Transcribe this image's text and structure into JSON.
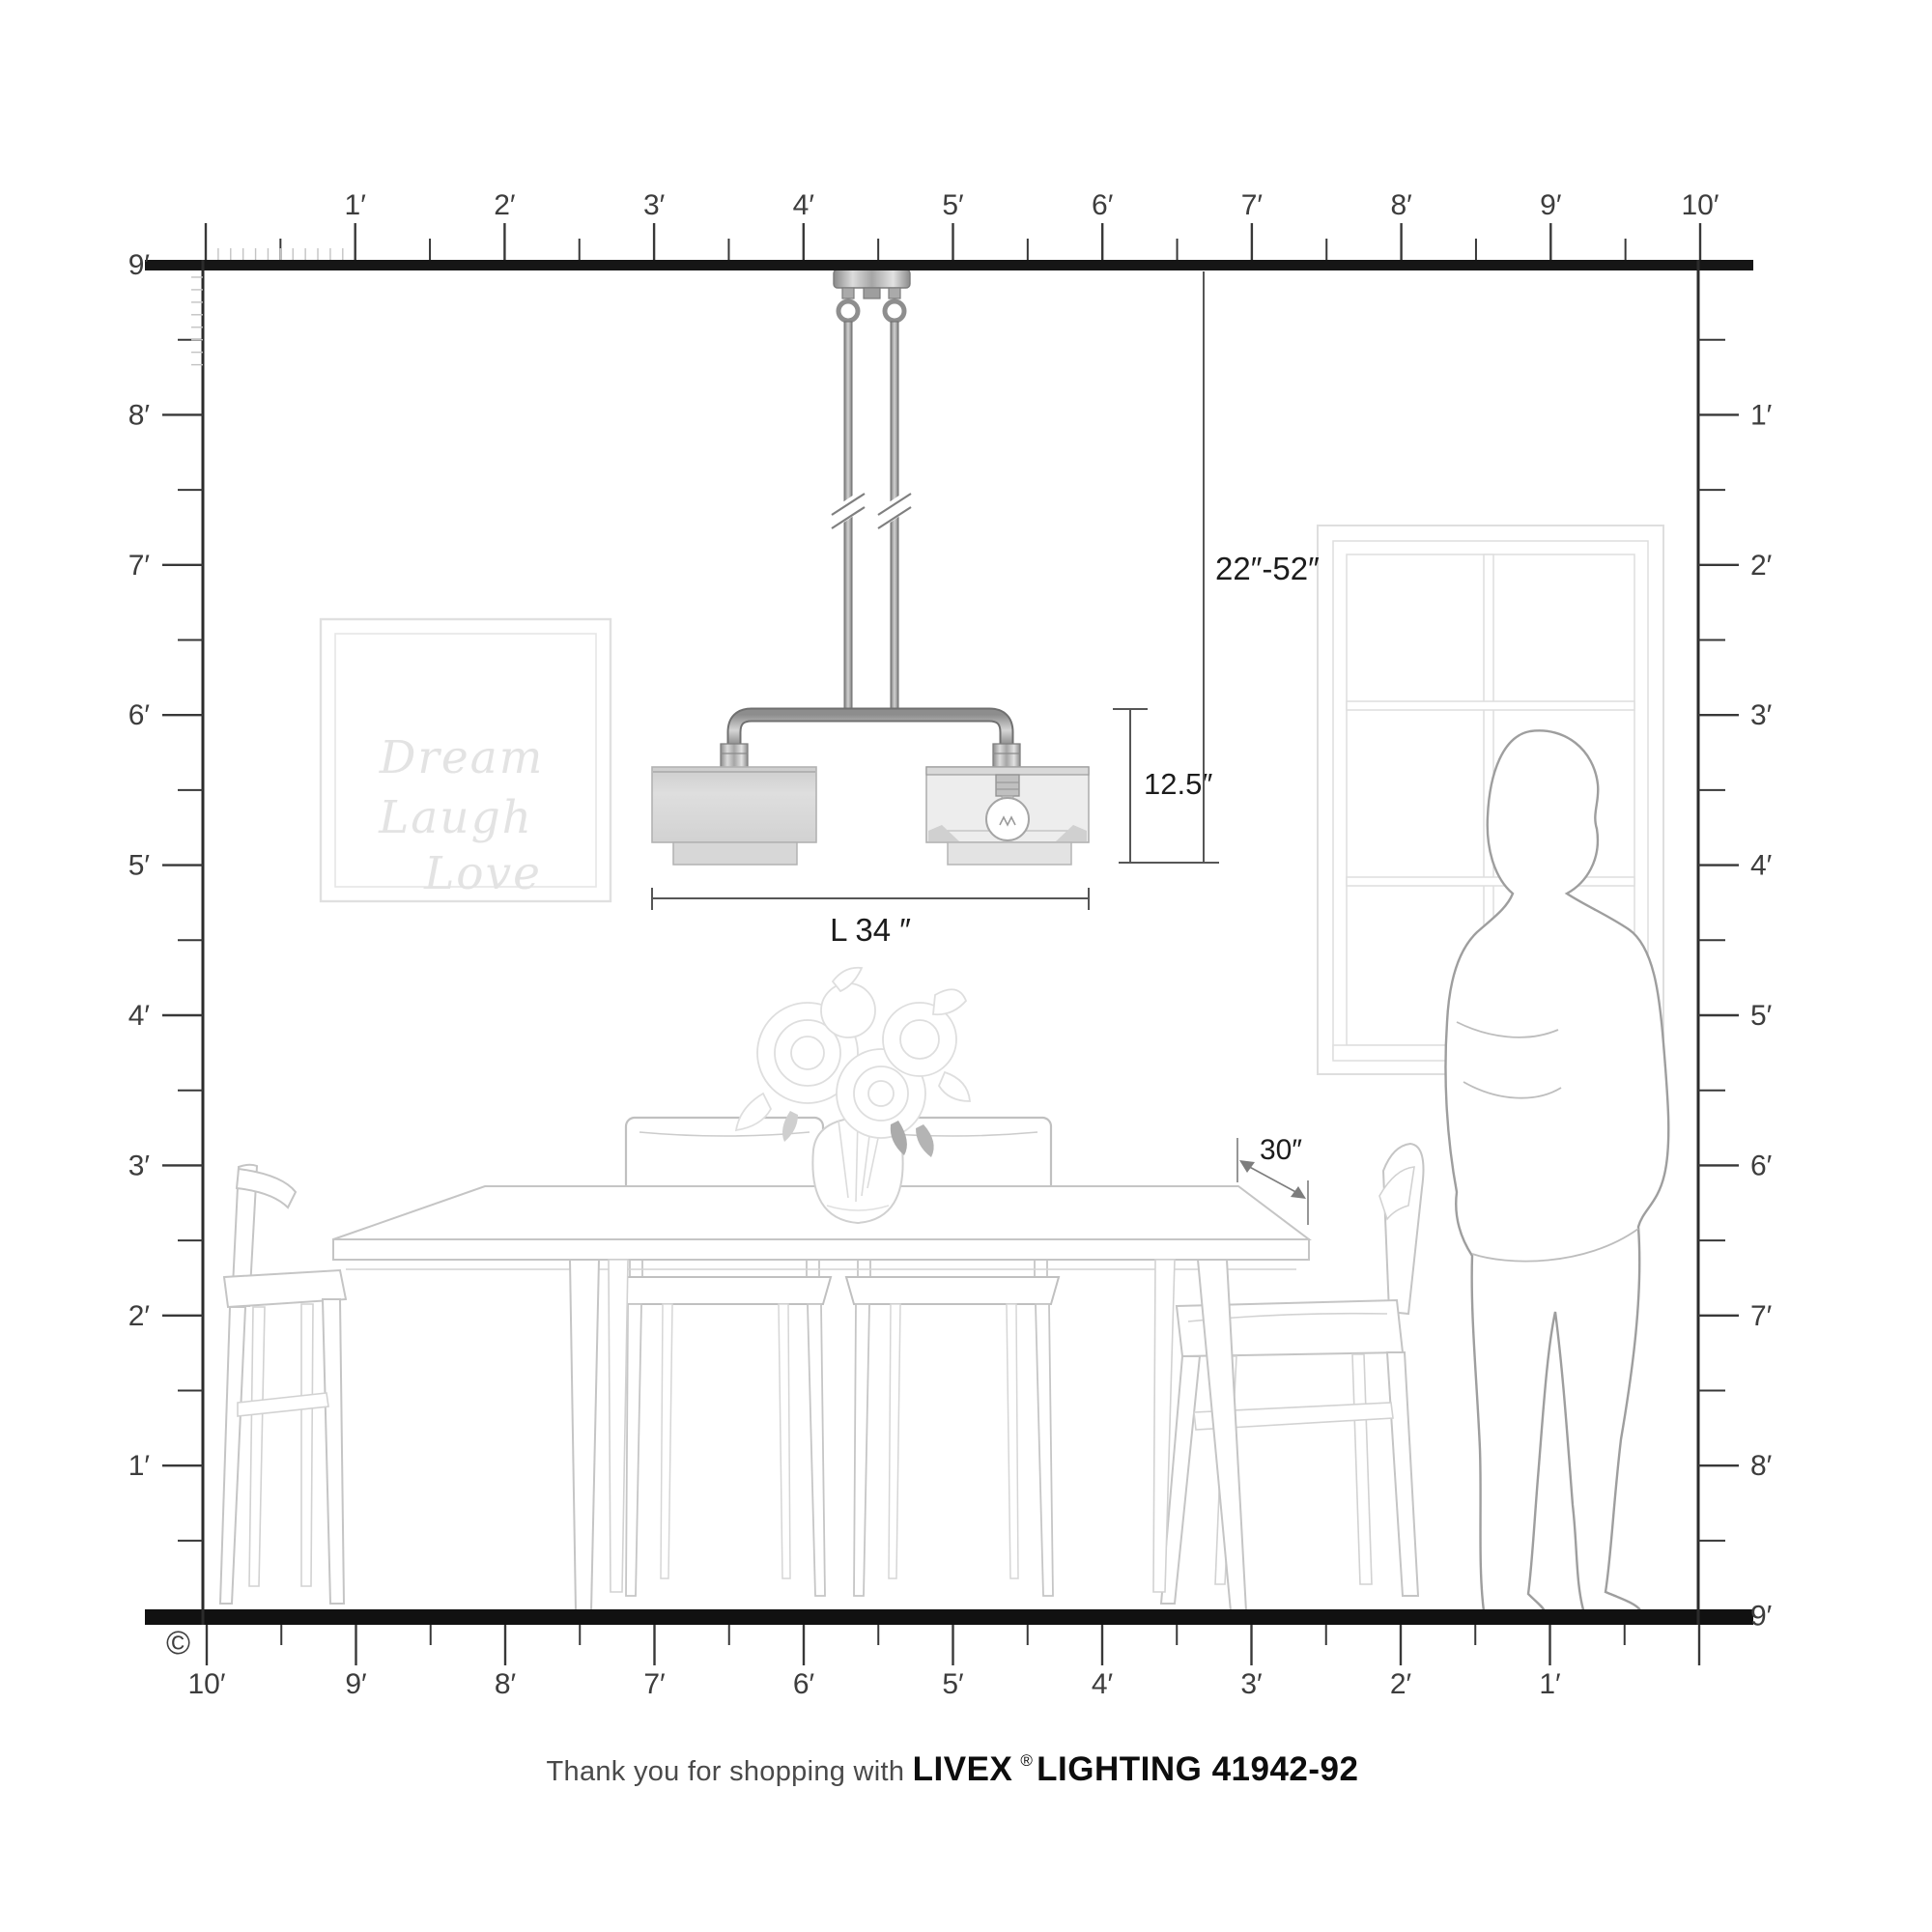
{
  "rulers": {
    "top": {
      "labels": [
        "1′",
        "2′",
        "3′",
        "4′",
        "5′",
        "6′",
        "7′",
        "8′",
        "9′",
        "10′"
      ]
    },
    "left": {
      "corner_label": "9′",
      "labels": [
        "8′",
        "7′",
        "6′",
        "5′",
        "4′",
        "3′",
        "2′",
        "1′"
      ]
    },
    "right": {
      "labels": [
        "1′",
        "2′",
        "3′",
        "4′",
        "5′",
        "6′",
        "7′",
        "8′",
        "9′"
      ]
    },
    "bottom": {
      "labels": [
        "10′",
        "9′",
        "8′",
        "7′",
        "6′",
        "5′",
        "4′",
        "3′",
        "2′",
        "1′"
      ]
    }
  },
  "dimensions": {
    "drop_range": "22″-52″",
    "fixture_height": "12.5″",
    "fixture_length": "L 34 ″",
    "table_depth": "30″"
  },
  "artwork": {
    "line1": "Dream",
    "line2": "Laugh",
    "line3": "Love"
  },
  "footer": {
    "prefix": "Thank you for shopping with",
    "brand": "LIVEX",
    "registered": "®",
    "suffix": "LIGHTING 41942-92"
  },
  "copyright_symbol": "©",
  "colors": {
    "wall_border": "#1a1a1a",
    "tick": "#383838",
    "dimension_line": "#565656",
    "furniture_line": "#c5c5c5",
    "fixture_metal": "#9a9a9a",
    "shade_fill": "#d9d9d9",
    "artwork_text": "#e3e3e3"
  }
}
